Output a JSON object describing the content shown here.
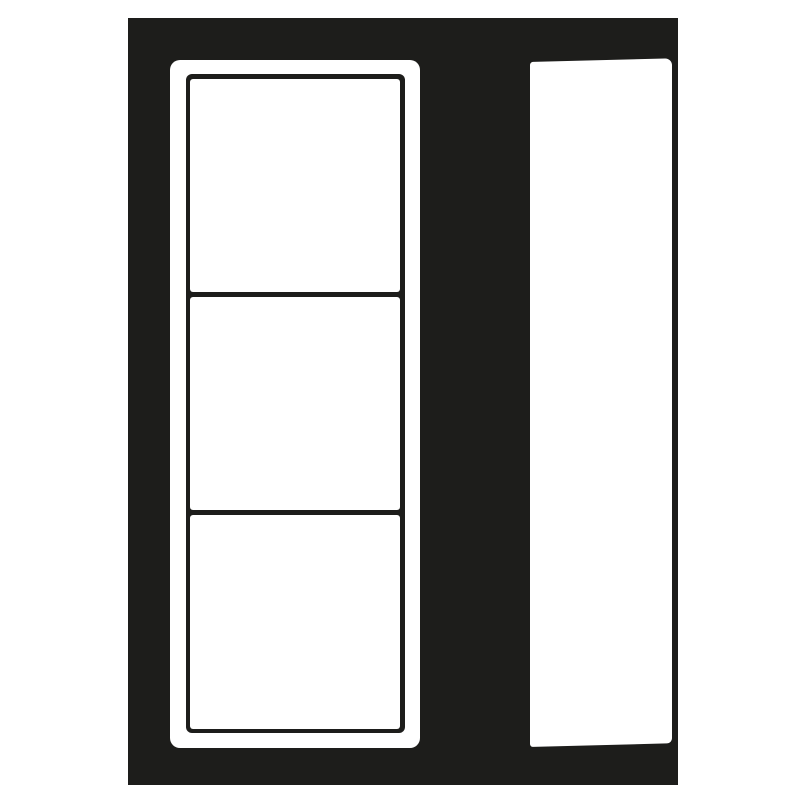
{
  "artwork": {
    "name": "monochrome-pictogram",
    "colors": {
      "ink": "#1d1d1b",
      "paper": "#ffffff"
    },
    "backdrop": {
      "name": "dark-backdrop"
    },
    "strip_panel": {
      "name": "frame-strip-panel",
      "frames": [
        {
          "name": "frame-1"
        },
        {
          "name": "frame-2"
        },
        {
          "name": "frame-3"
        }
      ]
    },
    "side_panel": {
      "name": "slanted-panel"
    }
  }
}
